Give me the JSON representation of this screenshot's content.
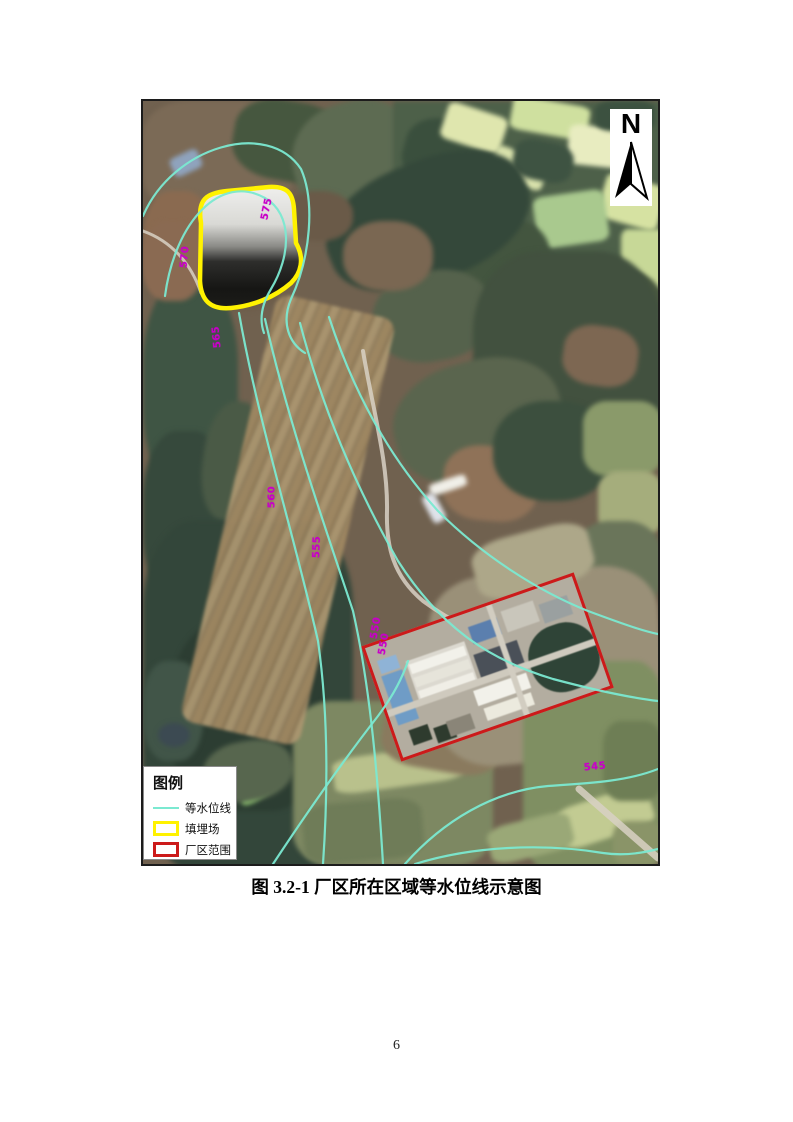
{
  "page": {
    "number": "6"
  },
  "figure": {
    "caption": "图 3.2-1 厂区所在区域等水位线示意图"
  },
  "map": {
    "compass_label": "N",
    "legend": {
      "title": "图例",
      "items": [
        {
          "id": "contour-line",
          "label": "等水位线",
          "symbol": "line",
          "color": "#7be9d1"
        },
        {
          "id": "landfill",
          "label": "填埋场",
          "symbol": "rect",
          "color": "#fff200"
        },
        {
          "id": "plant-area",
          "label": "厂区范围",
          "symbol": "rect",
          "color": "#cc1a1a"
        }
      ]
    },
    "contour_labels": [
      {
        "value": "575",
        "x": 124,
        "y": 108,
        "rot": -78
      },
      {
        "value": "570",
        "x": 42,
        "y": 156,
        "rot": -85
      },
      {
        "value": "565",
        "x": 74,
        "y": 236,
        "rot": -95
      },
      {
        "value": "560",
        "x": 129,
        "y": 396,
        "rot": -90
      },
      {
        "value": "555",
        "x": 174,
        "y": 446,
        "rot": -88
      },
      {
        "value": "550",
        "x": 233,
        "y": 527,
        "rot": -80
      },
      {
        "value": "550",
        "x": 241,
        "y": 543,
        "rot": -80
      },
      {
        "value": "545",
        "x": 452,
        "y": 666,
        "rot": -6
      }
    ],
    "colors": {
      "contour": "#7be9d1",
      "landfill_outline": "#fff200",
      "plant_outline": "#cc1a1a",
      "contour_label": "#c800c8"
    }
  }
}
